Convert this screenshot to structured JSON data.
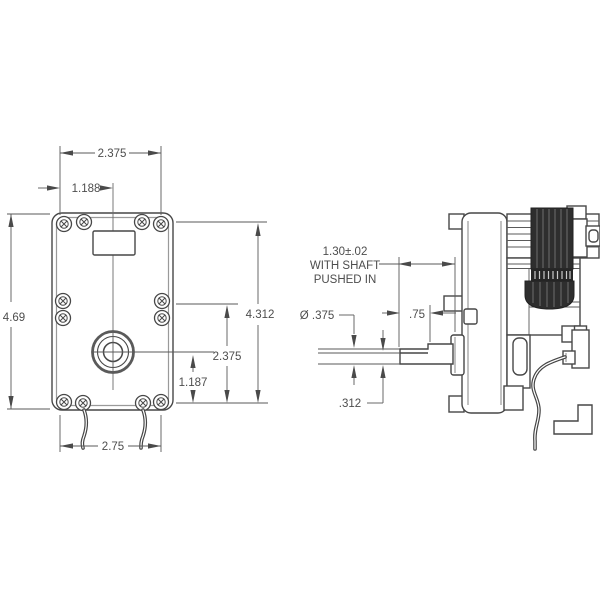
{
  "drawing": {
    "type": "engineering-dimension-drawing",
    "subject": "gear-motor-two-view",
    "front_view": {
      "dims": {
        "width_top": "2.375",
        "width_half": "1.188",
        "height": "4.69",
        "mount_span_vertical": "4.312",
        "mid_to_bottom": "2.375",
        "shaft_to_bottom": "1.187",
        "width_bottom": "2.75"
      }
    },
    "side_view": {
      "dims": {
        "shaft_pushed_line1": "1.30±.02",
        "shaft_pushed_line2": "WITH SHAFT",
        "shaft_pushed_line3": "PUSHED IN",
        "shaft_diameter": "Ø .375",
        "shaft_length": ".75",
        "shaft_flat": ".312"
      }
    },
    "colors": {
      "line": "#474747",
      "dim_line": "#5a5a5a",
      "text": "#4d4d4d",
      "coil_dark": "#2e2e2e",
      "inner_edge": "#9a9a9a",
      "background": "#ffffff"
    }
  }
}
